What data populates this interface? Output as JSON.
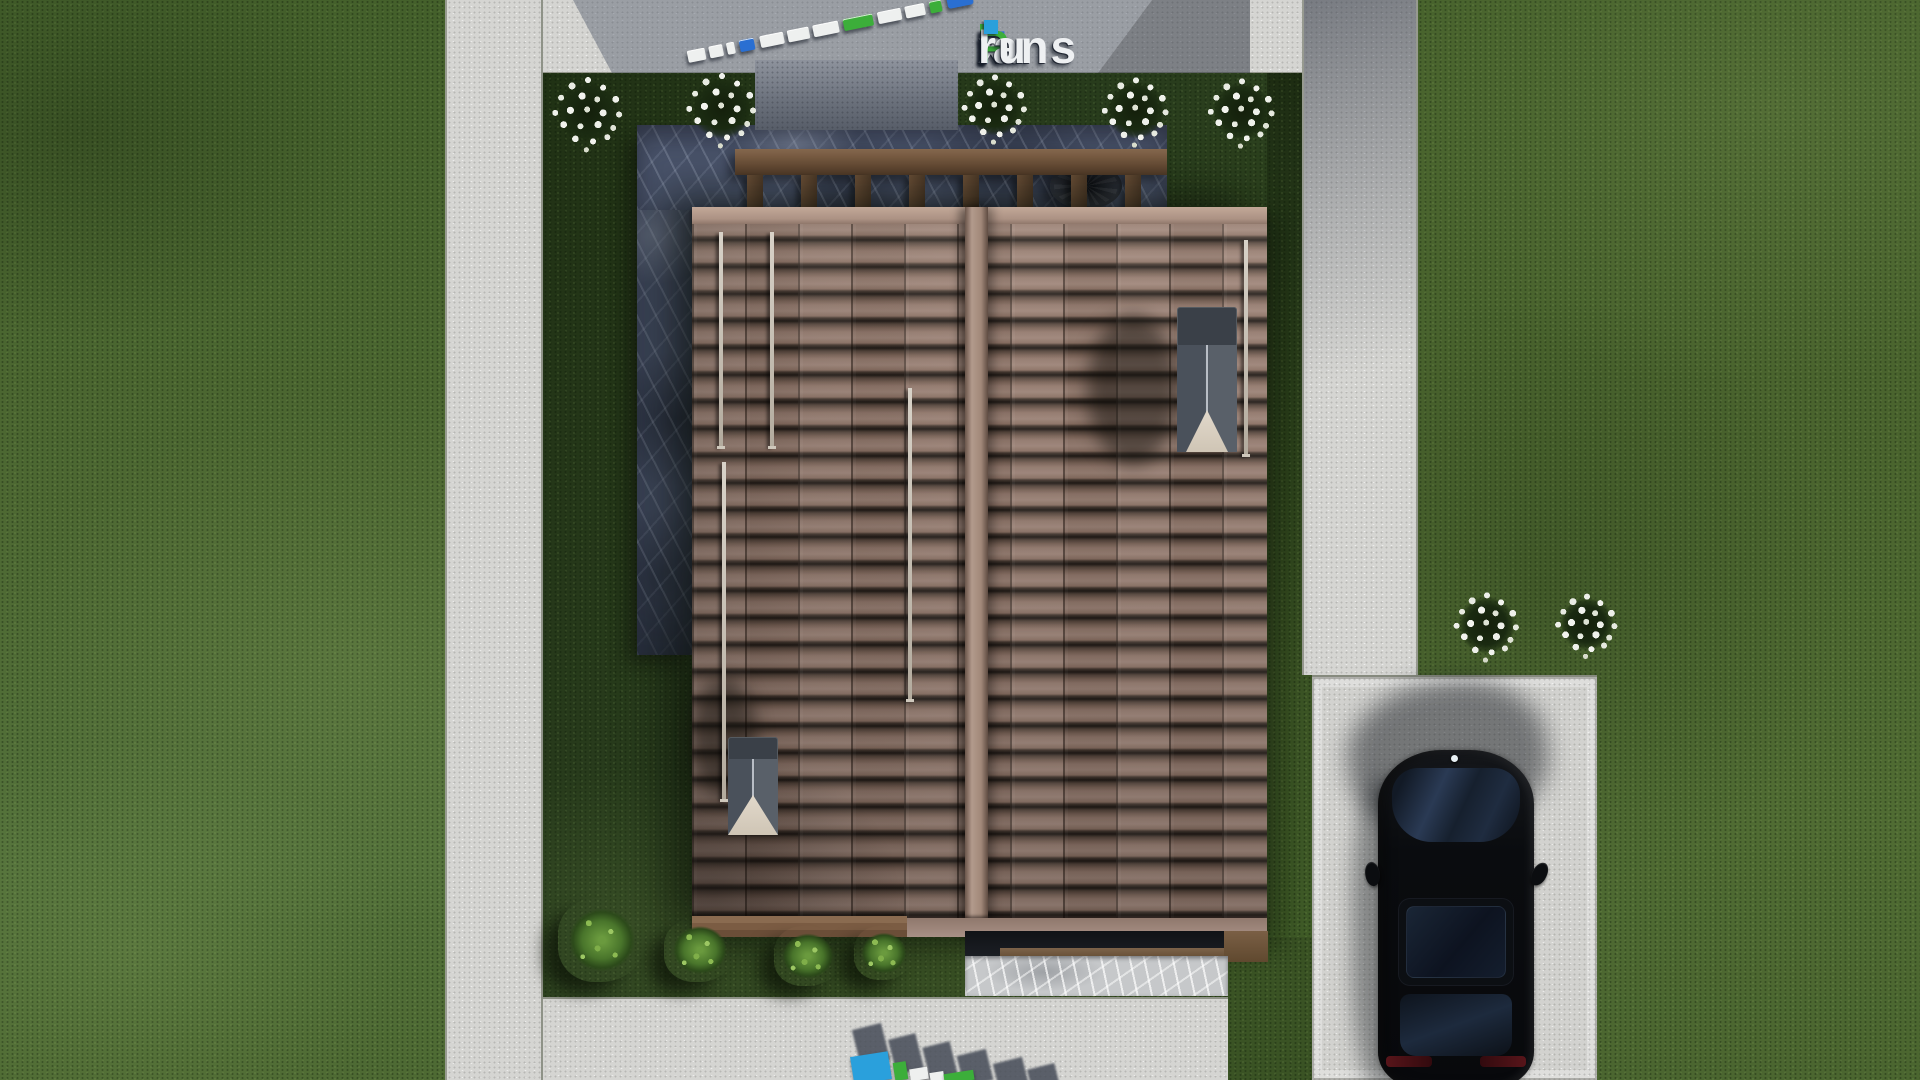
{
  "brand": {
    "f": "F",
    "i": "i",
    "x": "x",
    "p": "P",
    "lans": "lans",
    "dot": ".",
    "ru": "ru",
    "full": "FixPlans.ru"
  },
  "brand_colors": {
    "blue": "#2e6cd0",
    "green": "#3cae3a",
    "dot": "#2aa0dc",
    "white": "#eef0f2"
  },
  "palette": {
    "lawn": "#4d6832",
    "lawn_shadowed": "#293d1d",
    "concrete": "#d5d5d2",
    "concrete_shadow": "#6e7582",
    "roof_tile": "#8b7164",
    "roof_ridge": "#b29a8c",
    "slate_terrace": "#49536a",
    "pergola_wood": "#6b5038",
    "chimney_gray": "#3a4048",
    "car_black": "#0a0c10",
    "flower_white": "#eef0ea",
    "shrub_green": "#49752b"
  },
  "scene": {
    "description": "Aerial top-down 3D render of a site plan: two-section brown tiled roof house with pergola terrace and slate walkway, lawns with white flower bushes and green shrubs, concrete paths, driveway with black car parked",
    "watermark": "FixPlans.ru"
  }
}
